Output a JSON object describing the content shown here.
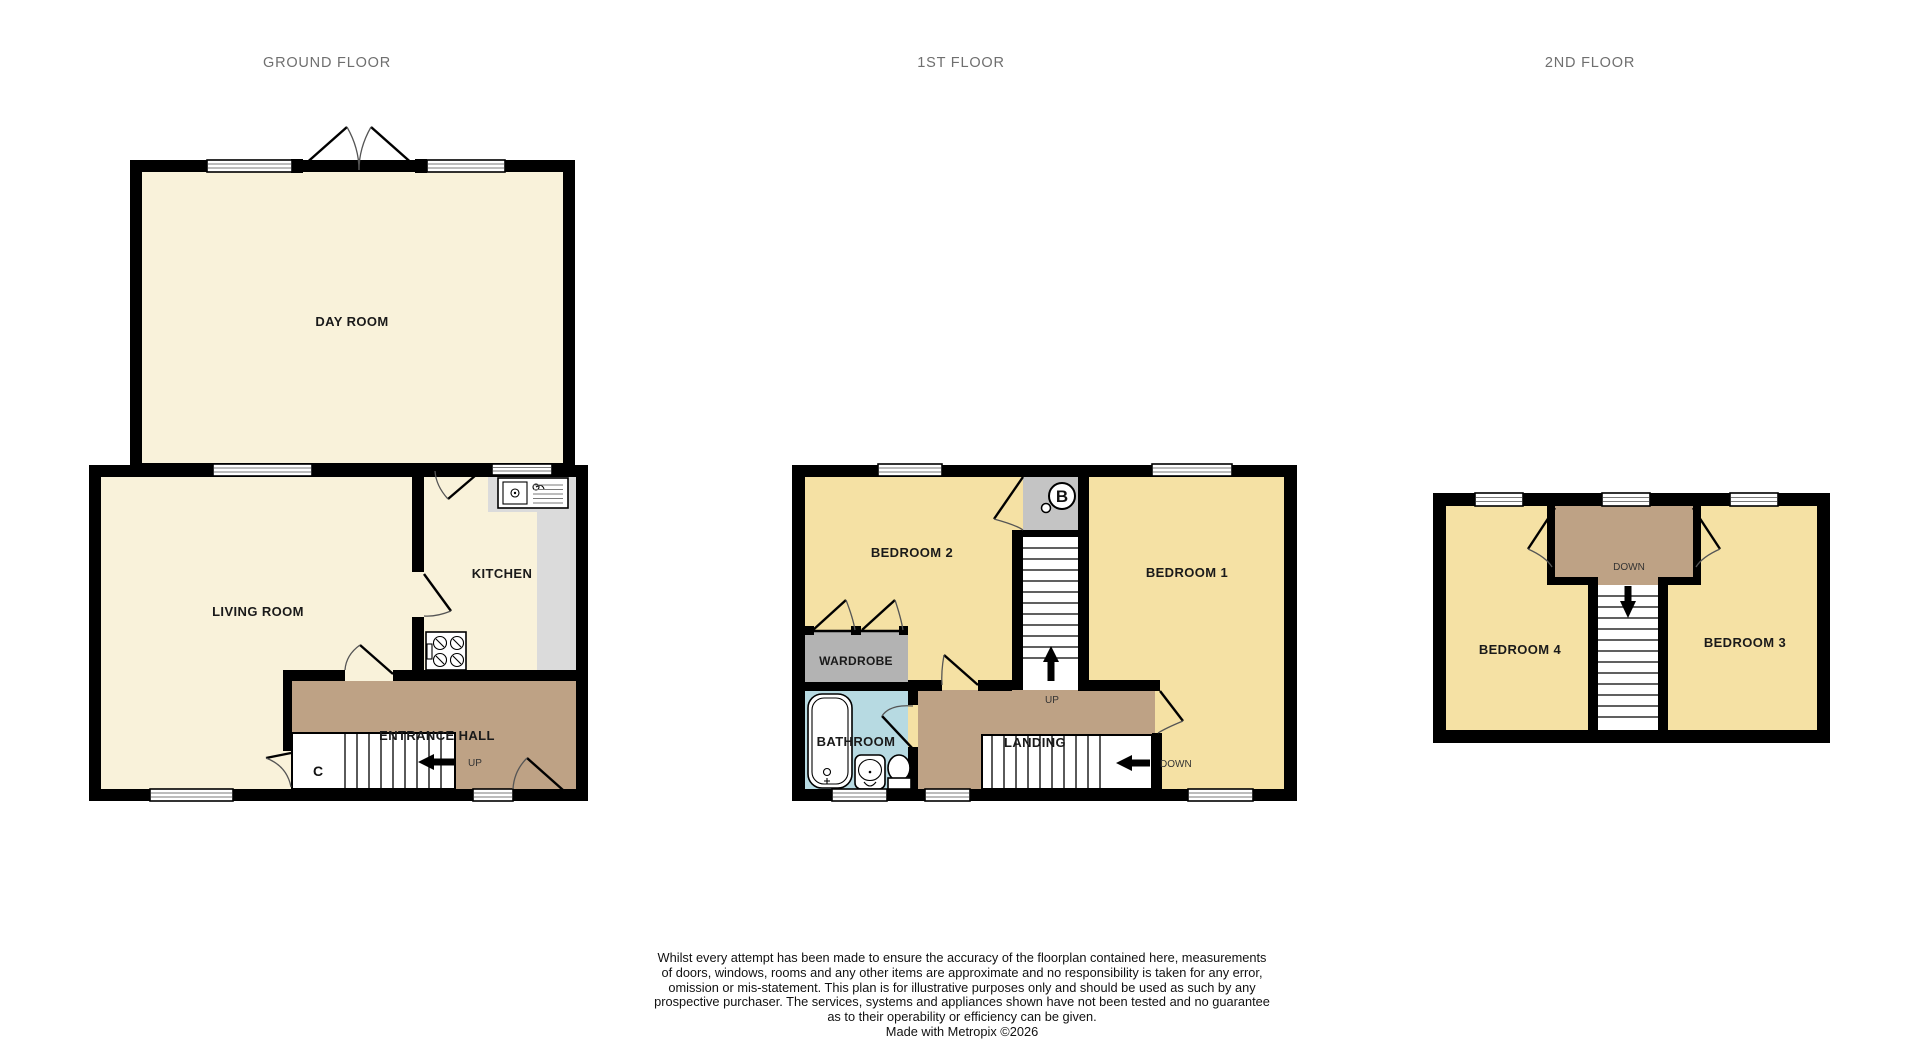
{
  "floors": {
    "ground": {
      "title": "GROUND FLOOR",
      "rooms": {
        "day_room": "DAY ROOM",
        "living_room": "LIVING ROOM",
        "kitchen": "KITCHEN",
        "entrance_hall": "ENTRANCE HALL"
      },
      "labels": {
        "cupboard": "C",
        "up": "UP"
      }
    },
    "first": {
      "title": "1ST FLOOR",
      "rooms": {
        "bedroom2": "BEDROOM 2",
        "bedroom1": "BEDROOM 1",
        "wardrobe": "WARDROBE",
        "bathroom": "BATHROOM",
        "landing": "LANDING"
      },
      "labels": {
        "up": "UP",
        "down": "DOWN",
        "boiler": "B"
      }
    },
    "second": {
      "title": "2ND FLOOR",
      "rooms": {
        "bedroom4": "BEDROOM 4",
        "bedroom3": "BEDROOM 3"
      },
      "labels": {
        "down": "DOWN"
      }
    }
  },
  "disclaimer": {
    "lines": [
      "Whilst every attempt has been made to ensure the accuracy of the floorplan contained here, measurements",
      "of doors, windows, rooms and any other items are approximate and no responsibility is taken for any error,",
      "omission or mis-statement. This plan is for illustrative purposes only and should be used as such by any",
      "prospective purchaser. The services, systems and appliances shown have not been tested and no guarantee",
      "as to their operability or efficiency can be given.",
      "Made with Metropix ©2026"
    ]
  },
  "colors": {
    "wall": "#000000",
    "ground_floor_fill": "#F9F2DA",
    "upper_floor_fill": "#F5E1A4",
    "hall_landing_fill": "#BEA285",
    "wardrobe_fill": "#B3B3B3",
    "boiler_cupboard_fill": "#C4C4C4",
    "bathroom_fill": "#B7DAE2",
    "kitchen_counter_fill": "#DBDBDB",
    "title_text": "#6F6F6F",
    "label_text": "#1A1A1A"
  }
}
